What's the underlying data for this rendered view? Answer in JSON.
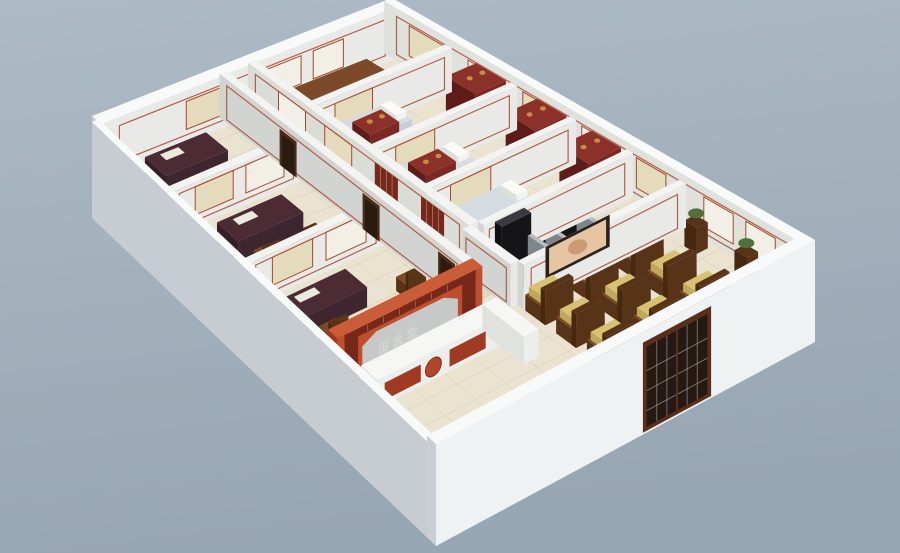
{
  "meta": {
    "description": "Isometric 3D cutaway render of a traditional Chinese medicine clinic floor plan with consultation rooms, treatment bays, massage room, waiting area and reception"
  },
  "signage": {
    "reception_wall_characters": "国医堂"
  },
  "palette": {
    "bgTop": "#aebbc6",
    "bgBot": "#97a6b3",
    "extFaceR": "#eff2f3",
    "extFaceL": "#c6ccd2",
    "extTop": "#f8f9f9",
    "inFaceLight": "#e9eae7",
    "inFaceShade": "#d2d4d1",
    "inFaceMid": "#dfe1dd",
    "inTop": "#f3f4f2",
    "floor": "#eae3d0",
    "floorLine": "#cfc6ad",
    "corridorTint": "#b69a68",
    "trimRed": "#a8492e",
    "partRed": "#bf4e2c",
    "partRedShade": "#9c3a20",
    "partRedTop": "#ca5c37",
    "latticeDark": "#77281a",
    "grayPanel": "#c6c9c7",
    "charSilver": "#dcdcd8",
    "counterFace": "#eceeec",
    "counterSide": "#e0e2e0",
    "counterTop": "#f6f7f5",
    "counterPanel": "#a03a23",
    "medallion": "#b2452a",
    "deskTop": "#4c2b35",
    "deskSide": "#342029",
    "wood": "#7c4a28",
    "woodDark": "#573318",
    "cushion": "#d7c273",
    "cushionShade": "#bfa85c",
    "bedSide": "#d3d8dc",
    "bedPad": "#c6cfd7",
    "pillow": "#f2f3f0",
    "cabFace": "#7c2722",
    "cabSide": "#5e1c18",
    "cabTop": "#8c312a",
    "mcBlack": "#232327",
    "mcDark": "#151518",
    "mcSeat": "#2e2e33",
    "metal": "#9aa0a6",
    "screenFrame": "#2a211c",
    "screenImg": "#e6c5a2",
    "screenBlob": "#c78f6b",
    "posterBeige": "#e4dabc",
    "posterWhite": "#f1efe6",
    "doorFrame": "#5a2f1a",
    "doorDark": "#261813",
    "doorLine": "#98a096",
    "jarGold": "#c29140",
    "plantGreen": "#50703c",
    "matTan": "#cdbd9a",
    "dispenser": "#eef0f1"
  },
  "inventory": {
    "consultation_rooms": 3,
    "back_office": 1,
    "treatment_bays": 3,
    "treatment_beds": 3,
    "herb_cabinets": 2,
    "display_shelves": 3,
    "massage_chairs": 2,
    "waiting_chairs": 9,
    "wall_posters": 19,
    "wall_screen": 1,
    "reception_counter": 1,
    "red_lattice_partition": 1,
    "entrance_lattice_door": 1,
    "plant_stands": 2,
    "water_dispenser": 1
  },
  "rooms": [
    {
      "name": "consultation-room-1",
      "items": [
        "desk",
        "chair",
        "posters"
      ]
    },
    {
      "name": "consultation-room-2",
      "items": [
        "desk",
        "chairs",
        "posters"
      ]
    },
    {
      "name": "consultation-room-3",
      "items": [
        "desk",
        "chairs",
        "side-table",
        "posters"
      ]
    },
    {
      "name": "back-office",
      "items": [
        "table",
        "chair",
        "posters"
      ]
    },
    {
      "name": "treatment-bay-1",
      "items": [
        "bed",
        "herb-cabinet",
        "display-shelf"
      ]
    },
    {
      "name": "treatment-bay-2",
      "items": [
        "bed",
        "herb-cabinet",
        "display-shelf"
      ]
    },
    {
      "name": "treatment-bay-3",
      "items": [
        "bed",
        "water-dispenser",
        "display-shelf"
      ]
    },
    {
      "name": "massage-room",
      "items": [
        "massage-chair",
        "massage-chair"
      ]
    },
    {
      "name": "waiting-area",
      "items": [
        "guest-chairs",
        "wall-screen",
        "plant-stands",
        "posters"
      ]
    },
    {
      "name": "reception",
      "items": [
        "red-lattice-partition",
        "signage",
        "l-shaped-counter"
      ]
    }
  ]
}
